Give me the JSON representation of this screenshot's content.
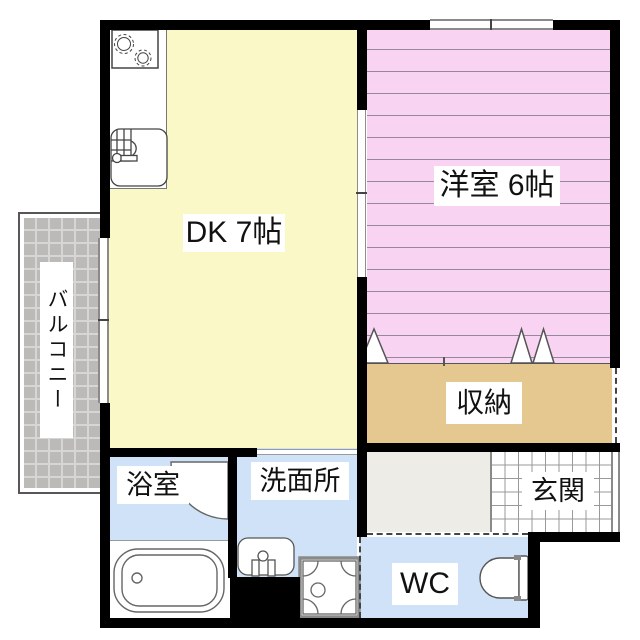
{
  "plan": {
    "rooms": {
      "dk": {
        "label": "DK 7帖",
        "color": "#faf8c6"
      },
      "western": {
        "label": "洋室 6帖",
        "color": "#f8d3f2"
      },
      "storage": {
        "label": "収納",
        "color": "#e5c88f"
      },
      "balcony": {
        "label": "バルコニー",
        "color": "#bcbab8"
      },
      "bath": {
        "label": "浴室",
        "color": "#cfe2f7"
      },
      "washroom": {
        "label": "洗面所",
        "color": "#cfe2f7"
      },
      "entrance": {
        "label": "玄関",
        "color": "#ffffff"
      },
      "wc": {
        "label": "WC",
        "color": "#cfe2f7"
      }
    },
    "colors": {
      "wall": "#000000",
      "window_frame": "#8a8a8a",
      "hallway": "#edece6",
      "stripe_line": "#94889b"
    },
    "fixtures": [
      "stove-burners",
      "kitchen-sink",
      "bath-door-swing",
      "bathtub",
      "washbasin",
      "washing-machine-pan",
      "toilet",
      "closet-door-triangles"
    ]
  }
}
